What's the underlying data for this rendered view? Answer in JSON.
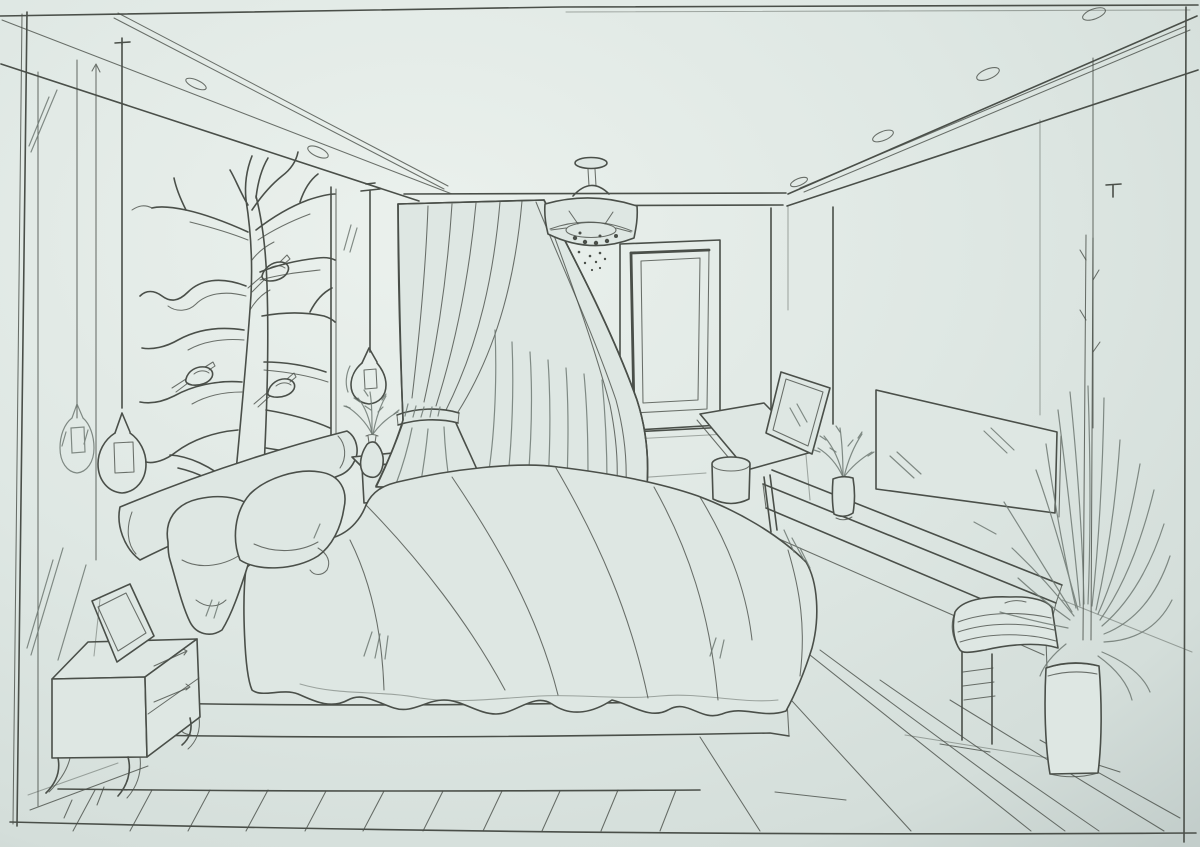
{
  "artwork": {
    "kind": "hand-drawn one-point perspective interior sketch",
    "subject": "bedroom with platform bed",
    "medium": "ink line drawing on tinted paper"
  },
  "palette": {
    "paper": "#dee7e3",
    "paper_light": "#eaf0ec",
    "paper_shade": "#c6d1ce",
    "ink": "#4a4f49",
    "ink_soft": "#6f7973"
  },
  "counts": {
    "birds_on_mural": 3,
    "pillows": 2,
    "ceiling_oval_lights_left": 2,
    "ceiling_oval_lights_right": 4,
    "pendant_lamps": 3,
    "nightstand_drawers": 2
  },
  "objects": {
    "frame_border": "hand-ruled rectangular border of the sketch",
    "ceiling": "cove ceiling soffit band with oval downlights",
    "chandelier": "drum ceiling lamp on stem with bulb dots",
    "tree_mural": "bare branching tree mural with perched birds",
    "pendant_lamps": "teardrop glass pendant lamps on long wires with mirror reflection",
    "curtain": "floor-length drape tied back at the waist",
    "window": "tall double-framed window on back wall",
    "bolster": "cylindrical bolster headboard along left wall",
    "head_shelf": "small shelf nightstand at bed head with sprig vase",
    "bed": "platform bed with rumpled duvet and scalloped hem",
    "pillows": "two rumpled pillows leaning on bolster",
    "platform": "two-step bed platform",
    "floor": "wood plank floor in perspective",
    "nightstand": "two-drawer nightstand with curved legs",
    "picture_frame": "picture frame leaning on nightstand",
    "vanity": "angled dressing table with leaning mirror",
    "pouf": "cylindrical stool in front of vanity",
    "console": "long wall console shelf with folded towels and stored books",
    "tv": "flat television panel on right wall with glare strokes",
    "console_vase": "cylinder vase with leafy sprigs on console",
    "plant": "tall potted dracaena with long blade leaves and high stems"
  }
}
